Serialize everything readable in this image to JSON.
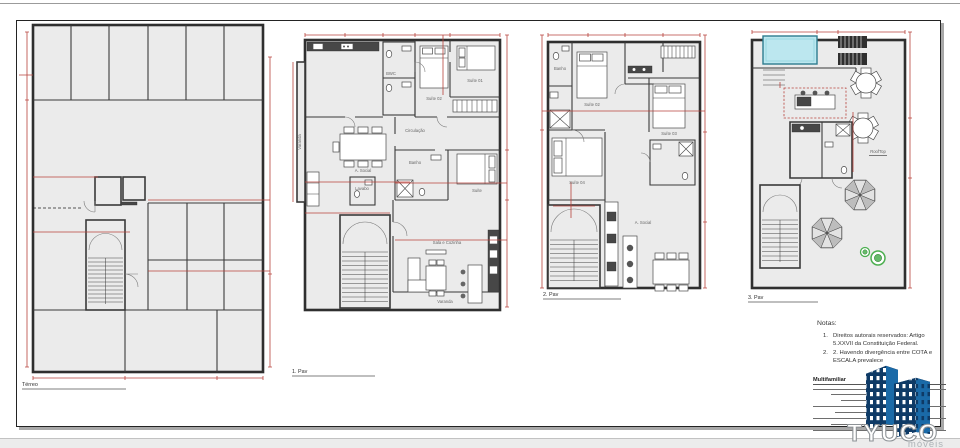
{
  "colors": {
    "dimension_red": "#b8433c",
    "wall_dark": "#2f2f2f",
    "floor_gray": "#ebebeb",
    "pool_fill": "#bce7ef",
    "pool_edge": "#2e7c8f",
    "plant_green": "#4caf50",
    "logo_dark_blue": "#0e3a66",
    "logo_mid_blue": "#1a6aa8",
    "logo_roof_blue": "#7ab2d8",
    "logo_text_gray": "#8d9296"
  },
  "plans": {
    "p1": {
      "label": "Térreo"
    },
    "p2": {
      "label": "1. Pav",
      "rooms": {
        "varanda_left": "Varanda",
        "bwc": "BWC",
        "suite02": "Suíte 02",
        "suite01": "Suíte 01",
        "social": "A. Social",
        "circulacao": "Circulação",
        "suite": "Suíte",
        "banho": "Banho",
        "lavabo": "Lavabo",
        "sala_cozinha": "Sala e Cozinha",
        "varanda": "Varanda"
      }
    },
    "p3": {
      "label": "2. Pav",
      "rooms": {
        "banho": "Banho",
        "suite02": "Suíte 02",
        "suite03": "Suíte 03",
        "suite04": "Suíte 04",
        "social": "A. Social"
      }
    },
    "p4": {
      "label": "3. Pav",
      "rooms": {
        "rooftop": "RoofTop"
      }
    }
  },
  "notes": {
    "title": "Notas:",
    "items": [
      {
        "num": "1.",
        "text": "Direitos autorais reservados: Artigo 5.XXVII da Constituição Federal."
      },
      {
        "num": "2.",
        "text": "2. Havendo divergência entre COTA e ESCALA prevalece"
      }
    ]
  },
  "title_block": {
    "heading": "Multifamiliar"
  },
  "logo": {
    "brand": "TYUCO",
    "tagline": "móveis"
  }
}
